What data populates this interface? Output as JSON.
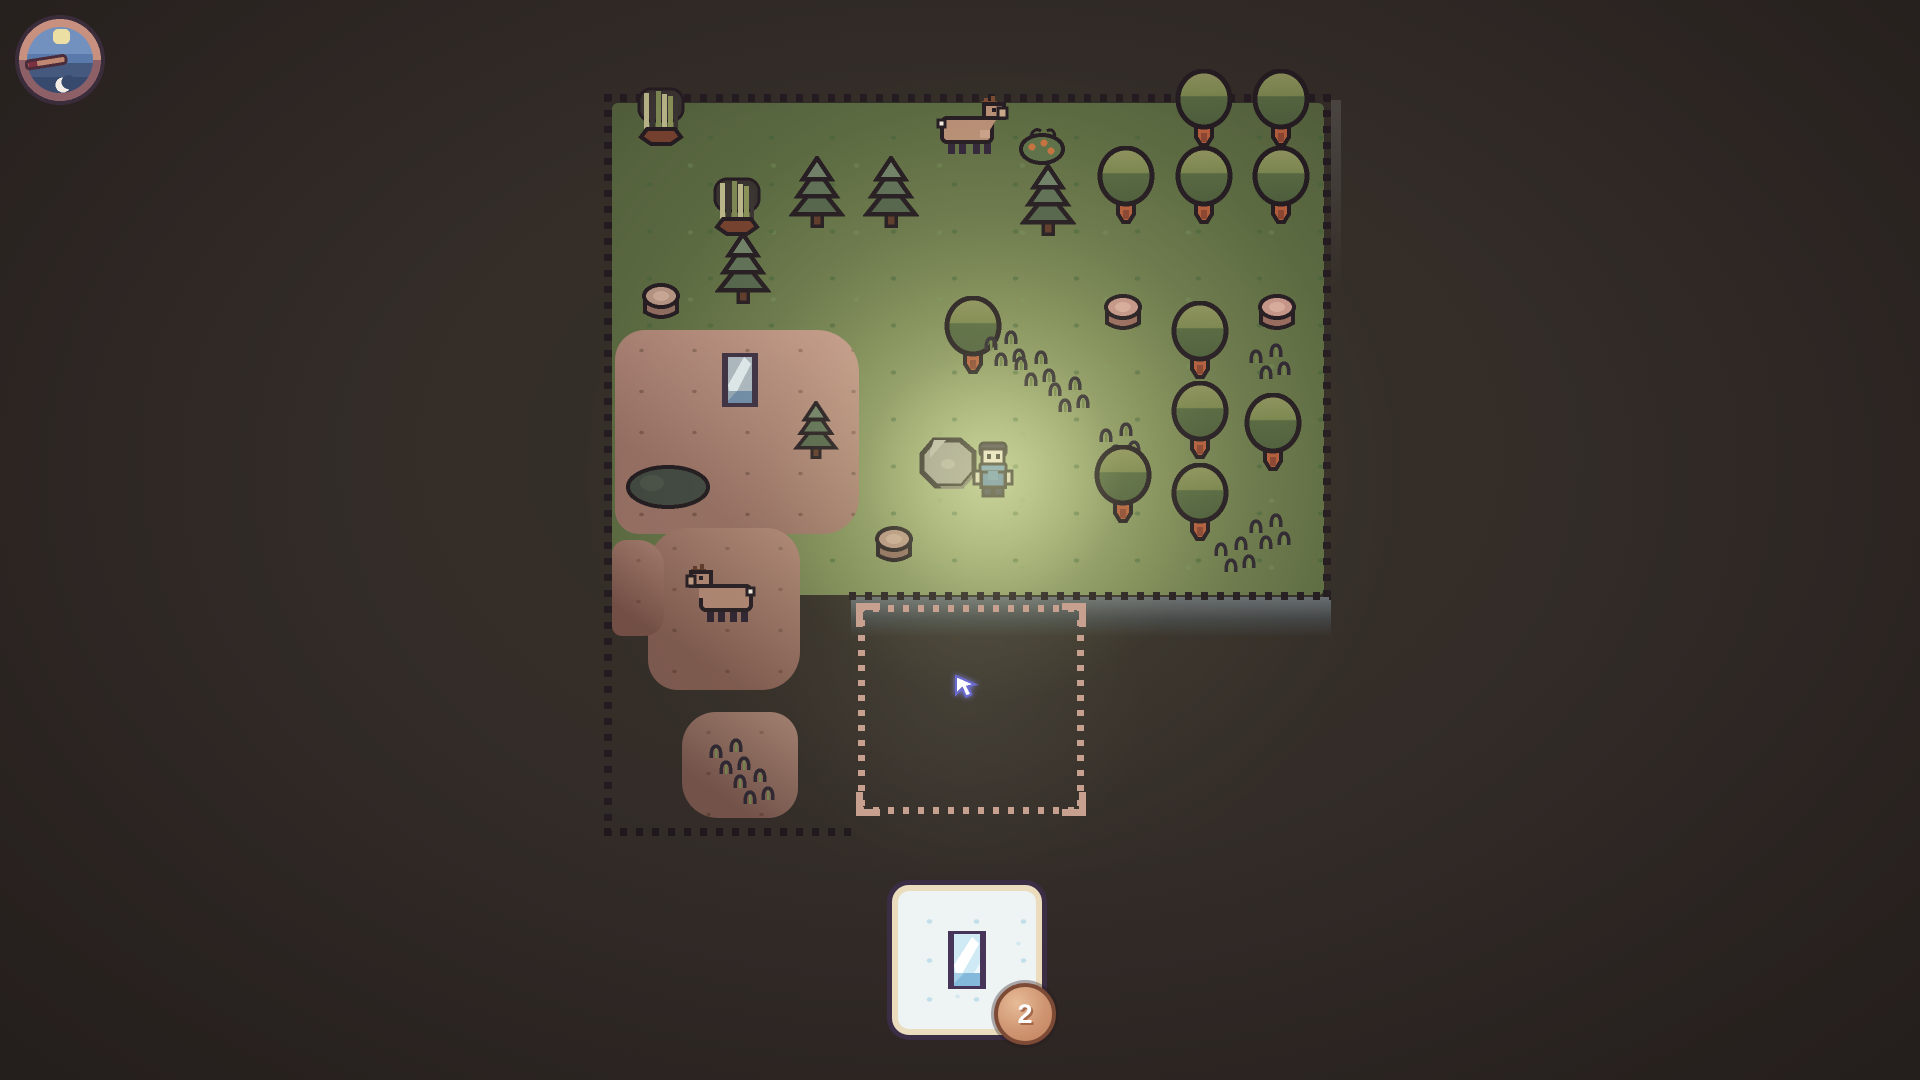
{
  "scene": {
    "background": "#322b29"
  },
  "hud": {
    "clock": {
      "icon": "day-night-clock",
      "sun": "sun-icon",
      "moon": "crescent-moon-icon",
      "hand": "pointing-left"
    },
    "inventory_card": {
      "icon": "glass-pane-icon",
      "count": "2"
    }
  },
  "palette": {
    "outline_dark": "#251c22",
    "grass_lit": "#aab689",
    "grass_dark": "#525f3c",
    "pink_bush": "#bb8e80",
    "placement_dots": "#c7a08f",
    "card_bg": "#eef3f4",
    "card_border": "#3a2d44",
    "badge_fill": "#cf9572",
    "glow": "#e6f0a0",
    "tree_canopy_top": "#8e925e",
    "tree_canopy_bottom": "#4d5d3c",
    "trunk_orange": "#b25c3b"
  },
  "map": {
    "placement_square": {
      "x": 858,
      "y": 605,
      "w": 226,
      "h": 209
    },
    "cursor": {
      "x": 950,
      "y": 670
    },
    "light_center": {
      "x": 993,
      "y": 478
    },
    "patches": [
      {
        "type": "terrain-green",
        "x": 612,
        "y": 103,
        "w": 712,
        "h": 492
      },
      {
        "type": "cliff-strip",
        "x": 1331,
        "y": 100,
        "w": 10,
        "h": 190
      },
      {
        "type": "cliff-band",
        "x": 851,
        "y": 597,
        "w": 480,
        "h": 40
      },
      {
        "type": "pink-blob",
        "x": 615,
        "y": 330,
        "w": 244,
        "h": 204,
        "fill": "#bb8e80",
        "r": "30px 42px 36px 24px"
      },
      {
        "type": "pink-blob",
        "x": 648,
        "y": 528,
        "w": 152,
        "h": 162,
        "fill": "#9c7265",
        "r": "40px 34px 38px 30px"
      },
      {
        "type": "pink-blob",
        "x": 612,
        "y": 540,
        "w": 52,
        "h": 96,
        "fill": "#8e6459",
        "r": "14px 26px 20px 10px"
      },
      {
        "type": "pink-blob",
        "x": 682,
        "y": 712,
        "w": 116,
        "h": 106,
        "fill": "#8f6a5f",
        "r": "34px 28px 30px 36px"
      }
    ],
    "borders": [
      {
        "x": 604,
        "y": 94,
        "w": 736,
        "h": 8,
        "dir": "h",
        "tone": "dark"
      },
      {
        "x": 604,
        "y": 94,
        "w": 8,
        "h": 742,
        "dir": "v",
        "tone": "dark"
      },
      {
        "x": 1323,
        "y": 94,
        "w": 8,
        "h": 512,
        "dir": "v",
        "tone": "dark"
      },
      {
        "x": 849,
        "y": 592,
        "w": 482,
        "h": 8,
        "dir": "h",
        "tone": "dark"
      },
      {
        "x": 604,
        "y": 828,
        "w": 254,
        "h": 8,
        "dir": "h",
        "tone": "dim"
      }
    ],
    "entities": [
      {
        "type": "reeds",
        "x": 661,
        "y": 118
      },
      {
        "type": "tree-round",
        "x": 1204,
        "y": 108
      },
      {
        "type": "tree-round",
        "x": 1281,
        "y": 108
      },
      {
        "type": "deer",
        "x": 973,
        "y": 128
      },
      {
        "type": "berry-bush",
        "x": 1042,
        "y": 145
      },
      {
        "type": "tree-round",
        "x": 1126,
        "y": 185
      },
      {
        "type": "tree-round",
        "x": 1204,
        "y": 185
      },
      {
        "type": "tree-round",
        "x": 1281,
        "y": 185
      },
      {
        "type": "pine",
        "x": 817,
        "y": 192
      },
      {
        "type": "pine",
        "x": 891,
        "y": 192
      },
      {
        "type": "pine",
        "x": 1048,
        "y": 200
      },
      {
        "type": "reeds",
        "x": 737,
        "y": 208
      },
      {
        "type": "pine",
        "x": 743,
        "y": 268
      },
      {
        "type": "stump",
        "x": 661,
        "y": 302
      },
      {
        "type": "stump-pink",
        "x": 1123,
        "y": 313
      },
      {
        "type": "stump-pink",
        "x": 1277,
        "y": 313
      },
      {
        "type": "tree-round",
        "x": 973,
        "y": 335
      },
      {
        "type": "tree-round",
        "x": 1200,
        "y": 340
      },
      {
        "type": "tall-grass",
        "x": 1008,
        "y": 352
      },
      {
        "type": "tall-grass",
        "x": 1273,
        "y": 365
      },
      {
        "type": "tall-grass",
        "x": 1038,
        "y": 372
      },
      {
        "type": "tall-grass",
        "x": 1072,
        "y": 398
      },
      {
        "type": "mirror",
        "x": 740,
        "y": 380
      },
      {
        "type": "tree-round",
        "x": 1200,
        "y": 420
      },
      {
        "type": "pine-small",
        "x": 816,
        "y": 430
      },
      {
        "type": "tree-round",
        "x": 1273,
        "y": 432
      },
      {
        "type": "tall-grass",
        "x": 1123,
        "y": 444
      },
      {
        "type": "rock",
        "x": 950,
        "y": 464
      },
      {
        "type": "player",
        "x": 993,
        "y": 472
      },
      {
        "type": "bush-dark",
        "x": 668,
        "y": 487
      },
      {
        "type": "tree-round",
        "x": 1123,
        "y": 484
      },
      {
        "type": "tree-round",
        "x": 1200,
        "y": 502
      },
      {
        "type": "tall-grass",
        "x": 1273,
        "y": 535
      },
      {
        "type": "tall-grass",
        "x": 1238,
        "y": 558
      },
      {
        "type": "stump",
        "x": 894,
        "y": 545
      },
      {
        "type": "deer-grazing",
        "x": 722,
        "y": 595
      },
      {
        "type": "tall-grass",
        "x": 733,
        "y": 760
      },
      {
        "type": "tall-grass",
        "x": 757,
        "y": 790
      }
    ]
  }
}
